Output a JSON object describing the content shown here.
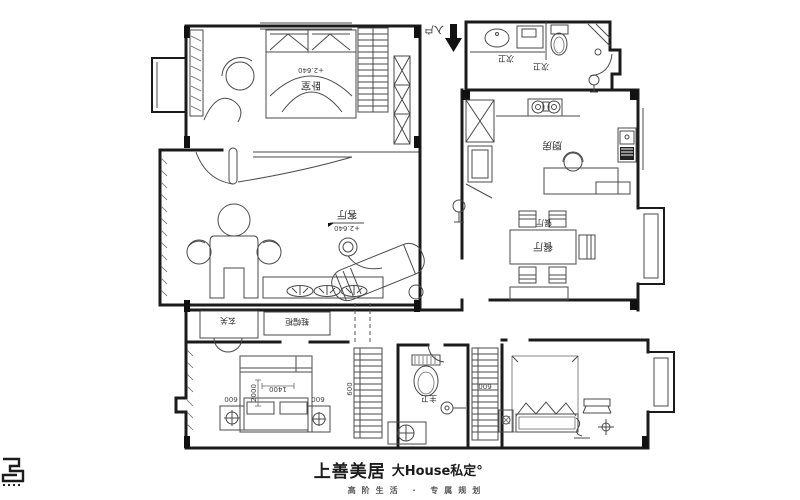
{
  "plan": {
    "entry": {
      "label": "入户"
    },
    "bedroom_top": {
      "label": "卧室",
      "elevation": "+2.640"
    },
    "bath_top": {
      "label_left": "次卫",
      "label_right": "次卫"
    },
    "kitchen": {
      "label": "厨房"
    },
    "dining": {
      "label": "餐厅",
      "label_small": "餐厅"
    },
    "living": {
      "label": "客厅",
      "elevation": "+2.640"
    },
    "foyer": {
      "label": "玄关"
    },
    "shoe_cabinet": {
      "label": "鞋帽柜"
    },
    "master_bath": {
      "label": "主卫"
    },
    "dims": {
      "d600": "600",
      "d1400": "1400",
      "d2000": "2000"
    }
  },
  "footer": {
    "brand": "上善美居",
    "product": "大House私定°",
    "tagline": "高阶生活 · 专属规划"
  },
  "colors": {
    "line": "#1b1b1b",
    "thin": "#4a4a4a",
    "text": "#2b2b2b"
  }
}
